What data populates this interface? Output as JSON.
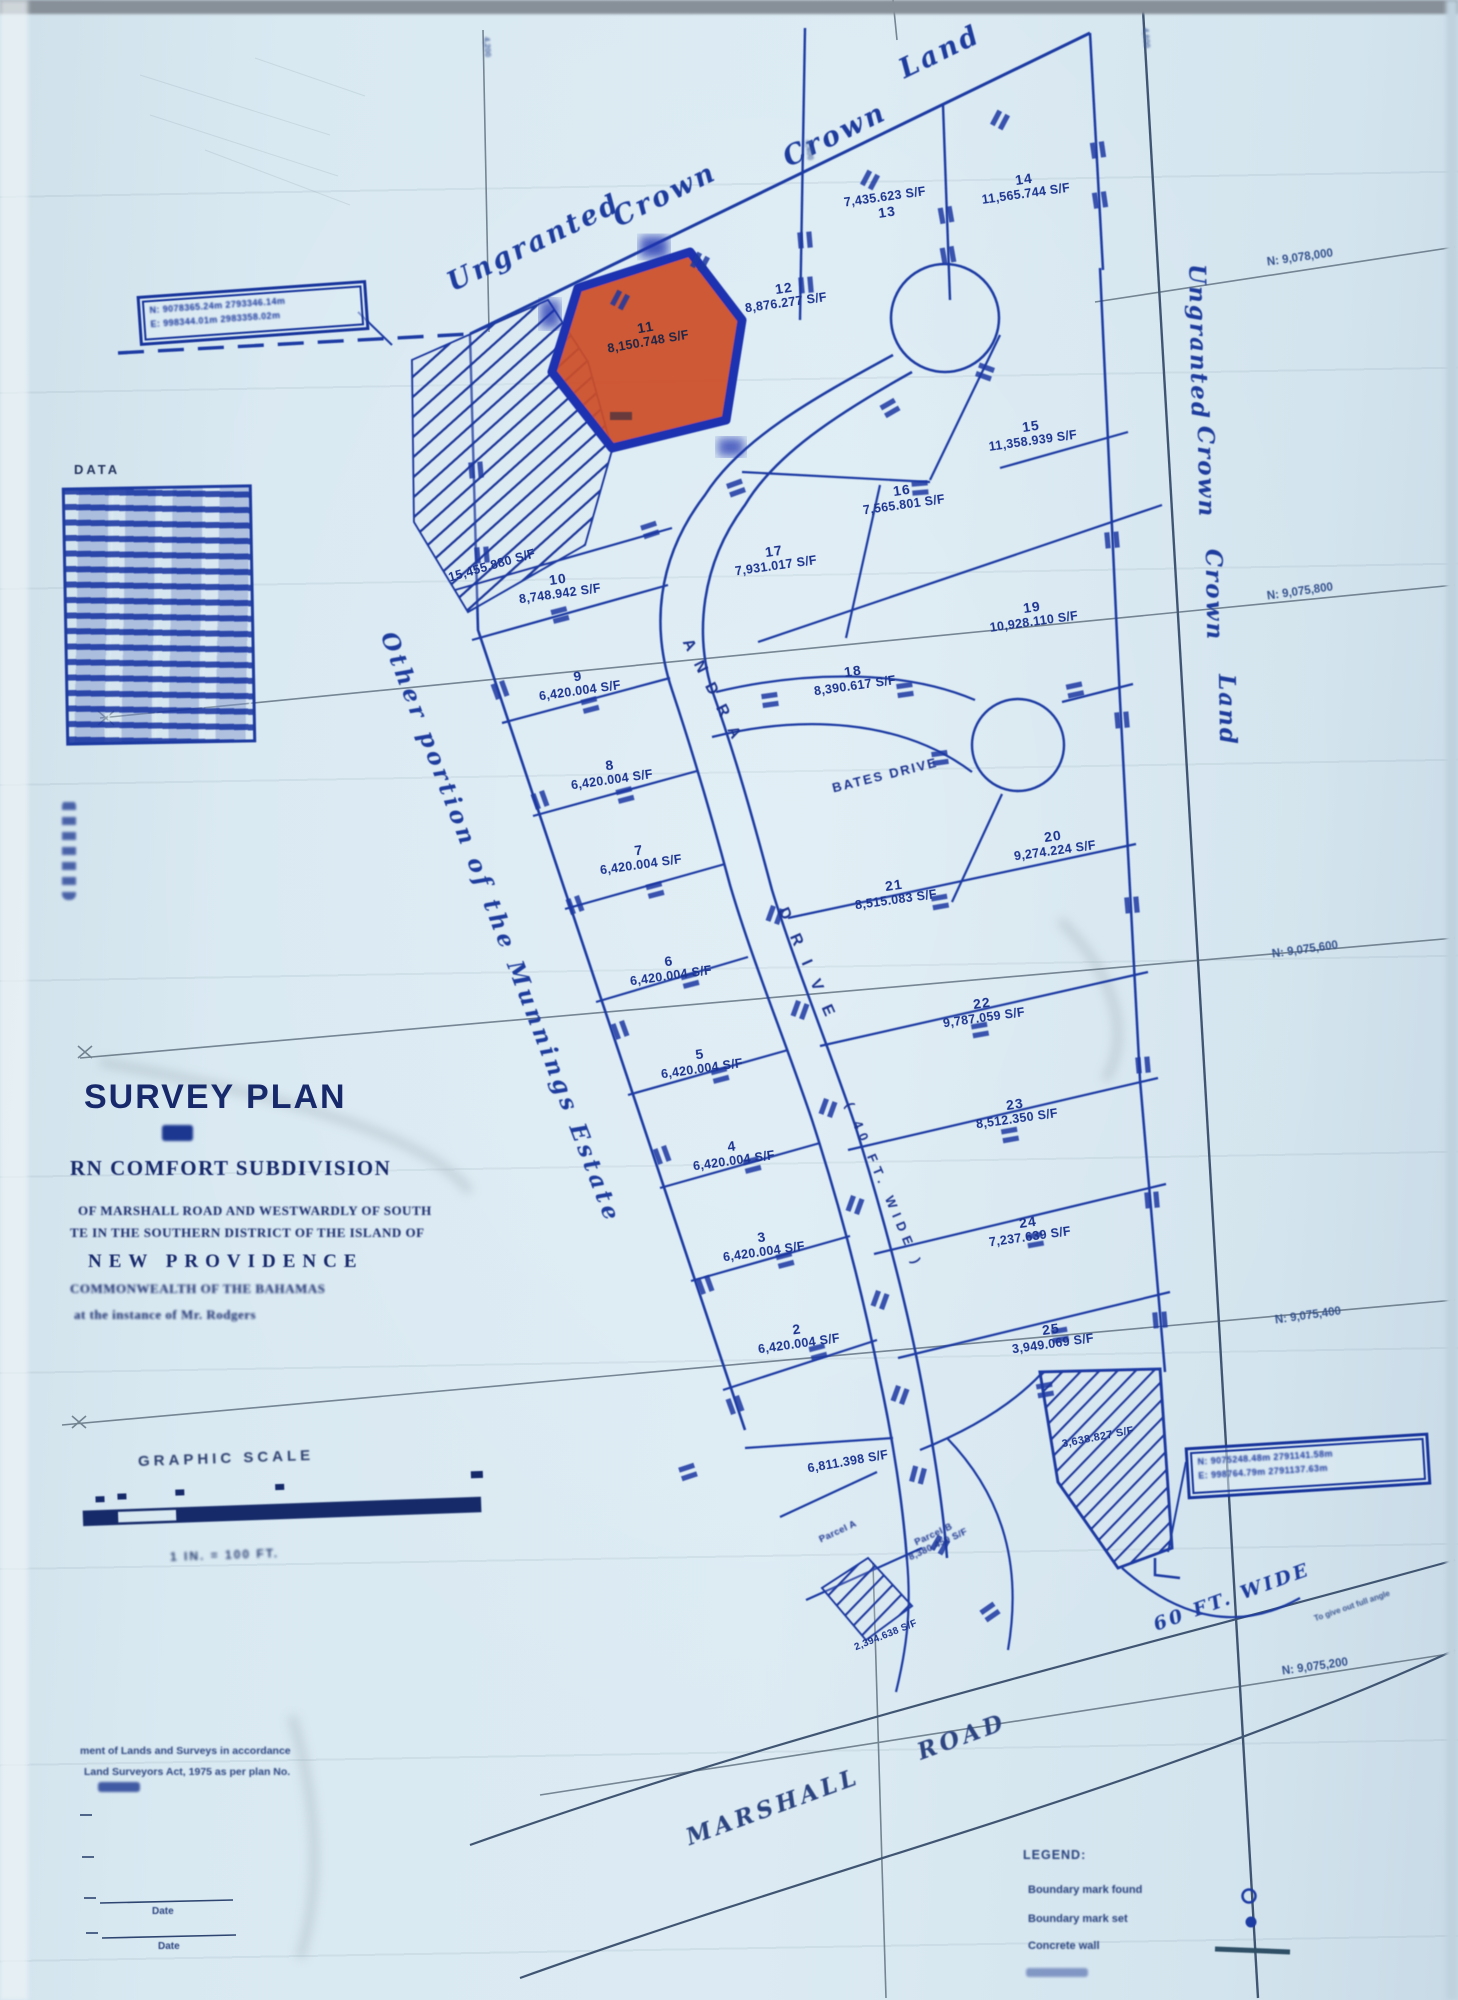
{
  "palette": {
    "paper": "#d9e8f1",
    "ink": "#1c3aa0",
    "highlight": "#cc4f28"
  },
  "corner_boxes": {
    "top_left": {
      "line1": "N: 9078365.24m  2793346.14m",
      "line2": "E: 998344.01m  2983358.02m"
    },
    "bottom_right": {
      "line1": "N: 9075248.48m  2791141.58m",
      "line2": "E: 998764.79m  2791137.63m"
    }
  },
  "boundary_labels": {
    "top": [
      "Ungranted",
      "Crown",
      "Crown",
      "Land"
    ],
    "right": [
      "Ungranted",
      "Crown",
      "Crown",
      "Land"
    ],
    "west": "Other portion of the Munnings Estate"
  },
  "grid": {
    "north_labels": [
      "N: 9,078,000",
      "N: 9,075,800",
      "N: 9,075,600",
      "N: 9,075,400",
      "N: 9,075,200"
    ],
    "east_tick_labels": [
      "4,200",
      "4,400",
      "4,600"
    ]
  },
  "data_table": {
    "heading": "DATA"
  },
  "lots": [
    {
      "num": "2",
      "area": "6,420.004 S/F"
    },
    {
      "num": "3",
      "area": "6,420.004 S/F"
    },
    {
      "num": "4",
      "area": "6,420.004 S/F"
    },
    {
      "num": "5",
      "area": "6,420.004 S/F"
    },
    {
      "num": "6",
      "area": "6,420.004 S/F"
    },
    {
      "num": "7",
      "area": "6,420.004 S/F"
    },
    {
      "num": "8",
      "area": "6,420.004 S/F"
    },
    {
      "num": "9",
      "area": "6,420.004 S/F"
    },
    {
      "num": "10",
      "area": "8,748.942 S/F"
    },
    {
      "num": "11",
      "area": "8,150.748 S/F"
    },
    {
      "num": "12",
      "area": "8,876.277 S/F"
    },
    {
      "num": "13",
      "area": "7,435.623 S/F"
    },
    {
      "num": "14",
      "area": "11,565.744 S/F"
    },
    {
      "num": "15",
      "area": "11,358.939 S/F"
    },
    {
      "num": "16",
      "area": "7,565.801 S/F"
    },
    {
      "num": "17",
      "area": "7,931.017 S/F"
    },
    {
      "num": "18",
      "area": "8,390.617 S/F"
    },
    {
      "num": "19",
      "area": "10,928.110 S/F"
    },
    {
      "num": "20",
      "area": "9,274.224 S/F"
    },
    {
      "num": "21",
      "area": "8,515.083 S/F"
    },
    {
      "num": "22",
      "area": "9,787.059 S/F"
    },
    {
      "num": "23",
      "area": "8,512.350 S/F"
    },
    {
      "num": "24",
      "area": "7,237.639 S/F"
    },
    {
      "num": "25",
      "area": "3,949.069 S/F"
    }
  ],
  "other_areas": {
    "lot_south": "6,811.398 S/F",
    "hatched_northwest": "15,455.880 S/F",
    "hatched_southeast": "3,638.827 S/F",
    "parcel_bottom": "2,394.638 S/F"
  },
  "parcels": {
    "a": {
      "label": "Parcel A"
    },
    "b": {
      "label": "Parcel B",
      "area": "8,380.459 S/F"
    }
  },
  "roads": {
    "andra": "ANDRA",
    "drive_word": "DRIVE",
    "width_note": "( 40 FT. WIDE )",
    "bates": "BATES DRIVE",
    "marshall_word1": "MARSHALL",
    "marshall_word2": "ROAD",
    "sixty_wide": "60 FT. WIDE",
    "sixty_note": "To give out full angle"
  },
  "title_block": {
    "title": "SURVEY PLAN",
    "of_word": "OF",
    "subdivision": "RN COMFORT SUBDIVISION",
    "location_line1": "OF MARSHALL ROAD AND WESTWARDLY OF SOUTH",
    "location_line2": "TE IN THE SOUTHERN DISTRICT OF THE ISLAND OF",
    "island": "NEW PROVIDENCE",
    "country": "COMMONWEALTH OF THE BAHAMAS",
    "instance": "at the instance of Mr. Rodgers"
  },
  "graphic_scale": {
    "heading": "GRAPHIC SCALE",
    "caption": "1 IN. = 100 FT."
  },
  "certification": {
    "line1": "ment of Lands and Surveys in accordance",
    "line2": "Land Surveyors Act, 1975 as per plan No.",
    "date_label": "Date"
  },
  "legend": {
    "heading": "LEGEND:",
    "items": [
      "Boundary mark found",
      "Boundary mark set",
      "Concrete wall"
    ]
  }
}
